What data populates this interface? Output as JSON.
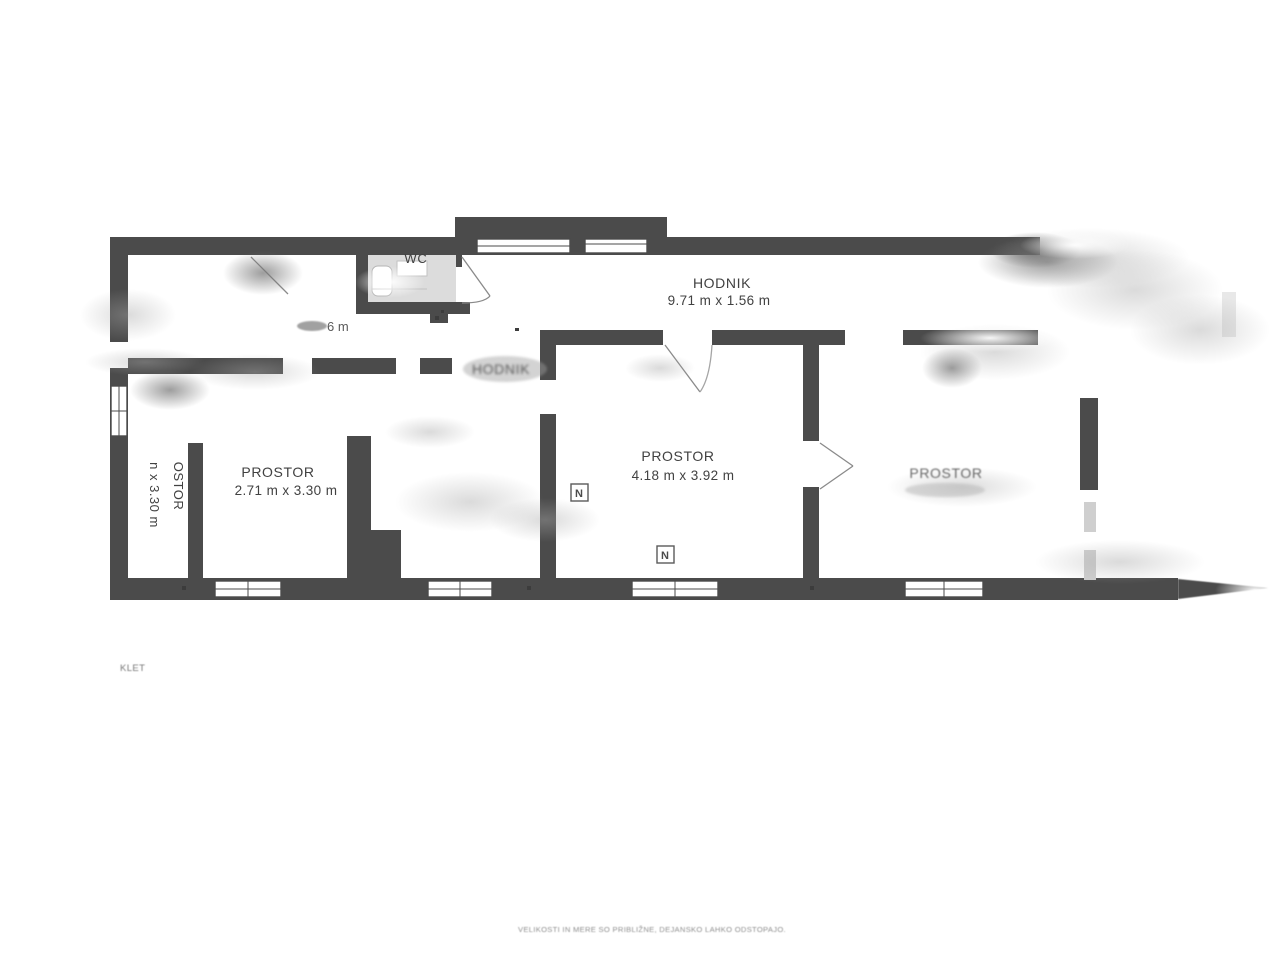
{
  "plan": {
    "rooms": {
      "wc": {
        "label": "WC"
      },
      "hodnik_main": {
        "label": "HODNIK",
        "dimensions": "9.71 m x 1.56 m"
      },
      "hodnik_small": {
        "label": "HODNIK"
      },
      "prostor_left": {
        "label": "PROSTOR",
        "dimensions": "2.71 m x 3.30 m"
      },
      "prostor_middle": {
        "label": "PROSTOR",
        "dimensions": "4.18 m x 3.92 m"
      },
      "prostor_right": {
        "label": "PROSTOR"
      },
      "prostor_narrow": {
        "label": "OSTOR",
        "dimensions": "n x 3.30 m"
      }
    },
    "annotations": {
      "floor_label": "KLET",
      "disclaimer": "VELIKOSTI IN MERE SO PRIBLIŽNE, DEJANSKO LAHKO ODSTOPAJO.",
      "dimension_remnant": "6 m",
      "radiator_symbol": "N"
    },
    "colors": {
      "wall": "#4b4b4b",
      "wc_floor": "#dcdcdc",
      "label_text": "#414141",
      "faded_text": "#8f8f8f",
      "background": "#ffffff"
    }
  }
}
